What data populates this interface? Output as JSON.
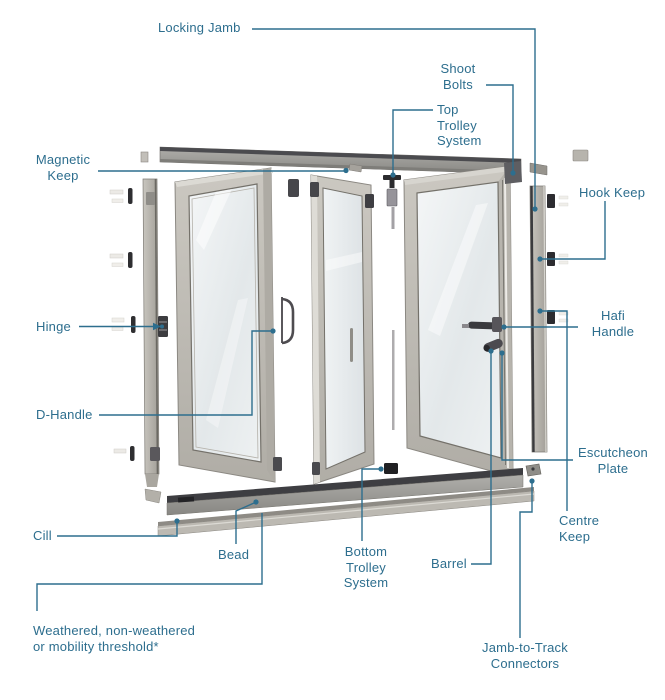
{
  "figure": {
    "type": "exploded-parts-diagram",
    "subject": "Bifold door system parts diagram",
    "panel_count": 3
  },
  "colors": {
    "label_text": "#2d6e8e",
    "leader_line": "#2d6e8e",
    "frame_grey": "#bdbab3",
    "hardware_dark": "#2e2e31",
    "background": "#ffffff"
  },
  "labels": {
    "locking_jamb": "Locking Jamb",
    "shoot_bolts": "Shoot Bolts",
    "top_trolley": "Top Trolley System",
    "magnetic_keep": "Magnetic Keep",
    "hook_keep": "Hook Keep",
    "hinge": "Hinge",
    "hafi_handle": "Hafi Handle",
    "d_handle": "D-Handle",
    "escutcheon_plate": "Escutcheon Plate",
    "centre_keep": "Centre Keep",
    "cill": "Cill",
    "bead": "Bead",
    "bottom_trolley": "Bottom Trolley System",
    "barrel": "Barrel",
    "threshold": "Weathered, non-weathered or mobility threshold*",
    "jamb_to_track": "Jamb-to-Track Connectors"
  }
}
